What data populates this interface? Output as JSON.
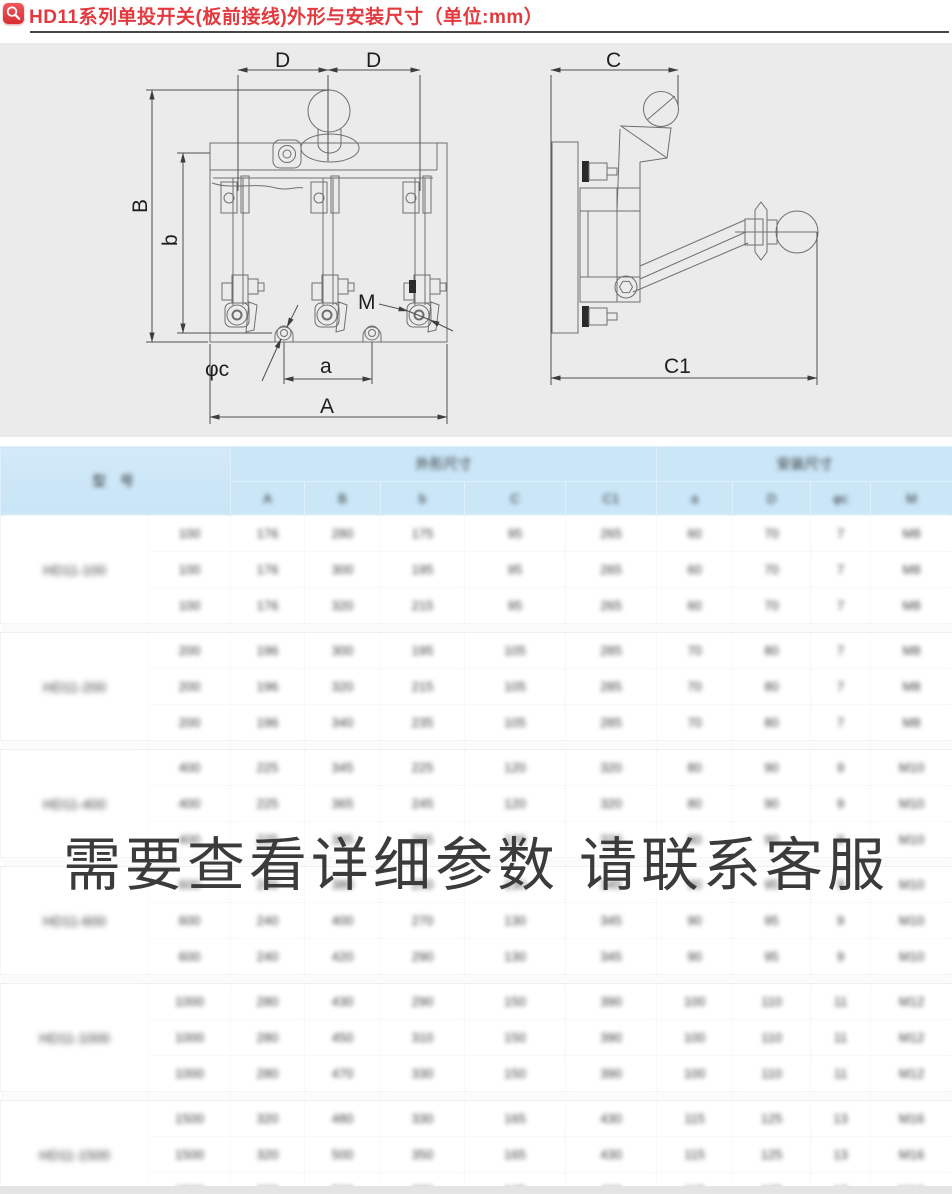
{
  "colors": {
    "accent_red": "#e23a3e",
    "header_blue": "#cae6f7",
    "diagram_bg": "#ebebeb",
    "line": "#6b6b6b"
  },
  "header": {
    "title": "HD11系列单投开关(板前接线)外形与安装尺寸（单位:mm）",
    "icon": "magnifier-icon"
  },
  "diagram": {
    "labels": {
      "D_left": "D",
      "D_right": "D",
      "B": "B",
      "b": "b",
      "M": "M",
      "phi_c": "φc",
      "a": "a",
      "A": "A",
      "C": "C",
      "C1": "C1"
    }
  },
  "watermark": {
    "text": "需要查看详细参数 请联系客服"
  },
  "table": {
    "blurred": true,
    "header": {
      "model": "型 号",
      "group1": "外形尺寸",
      "group2": "安装尺寸",
      "sub": [
        "A",
        "B",
        "b",
        "C",
        "C1",
        "a",
        "D",
        "φc",
        "M"
      ]
    },
    "groups": [
      {
        "model": "HD11-100",
        "rows": [
          [
            "100",
            "176",
            "280",
            "175",
            "95",
            "265",
            "60",
            "70",
            "7",
            "M8"
          ],
          [
            "100",
            "176",
            "300",
            "195",
            "95",
            "265",
            "60",
            "70",
            "7",
            "M8"
          ],
          [
            "100",
            "176",
            "320",
            "215",
            "95",
            "265",
            "60",
            "70",
            "7",
            "M8"
          ]
        ]
      },
      {
        "model": "HD11-200",
        "rows": [
          [
            "200",
            "196",
            "300",
            "195",
            "105",
            "285",
            "70",
            "80",
            "7",
            "M8"
          ],
          [
            "200",
            "196",
            "320",
            "215",
            "105",
            "285",
            "70",
            "80",
            "7",
            "M8"
          ],
          [
            "200",
            "196",
            "340",
            "235",
            "105",
            "285",
            "70",
            "80",
            "7",
            "M8"
          ]
        ]
      },
      {
        "model": "HD11-400",
        "rows": [
          [
            "400",
            "225",
            "345",
            "225",
            "120",
            "320",
            "80",
            "90",
            "9",
            "M10"
          ],
          [
            "400",
            "225",
            "365",
            "245",
            "120",
            "320",
            "80",
            "90",
            "9",
            "M10"
          ],
          [
            "400",
            "225",
            "385",
            "265",
            "120",
            "320",
            "80",
            "90",
            "9",
            "M10"
          ]
        ]
      },
      {
        "model": "HD11-600",
        "rows": [
          [
            "600",
            "240",
            "380",
            "250",
            "130",
            "345",
            "90",
            "95",
            "9",
            "M10"
          ],
          [
            "600",
            "240",
            "400",
            "270",
            "130",
            "345",
            "90",
            "95",
            "9",
            "M10"
          ],
          [
            "600",
            "240",
            "420",
            "290",
            "130",
            "345",
            "90",
            "95",
            "9",
            "M10"
          ]
        ]
      },
      {
        "model": "HD11-1000",
        "rows": [
          [
            "1000",
            "280",
            "430",
            "290",
            "150",
            "390",
            "100",
            "110",
            "11",
            "M12"
          ],
          [
            "1000",
            "280",
            "450",
            "310",
            "150",
            "390",
            "100",
            "110",
            "11",
            "M12"
          ],
          [
            "1000",
            "280",
            "470",
            "330",
            "150",
            "390",
            "100",
            "110",
            "11",
            "M12"
          ]
        ]
      },
      {
        "model": "HD11-1500",
        "rows": [
          [
            "1500",
            "320",
            "480",
            "330",
            "165",
            "430",
            "115",
            "125",
            "13",
            "M16"
          ],
          [
            "1500",
            "320",
            "500",
            "350",
            "165",
            "430",
            "115",
            "125",
            "13",
            "M16"
          ],
          [
            "1500",
            "320",
            "520",
            "370",
            "165",
            "430",
            "115",
            "125",
            "13",
            "M16"
          ]
        ]
      }
    ]
  }
}
